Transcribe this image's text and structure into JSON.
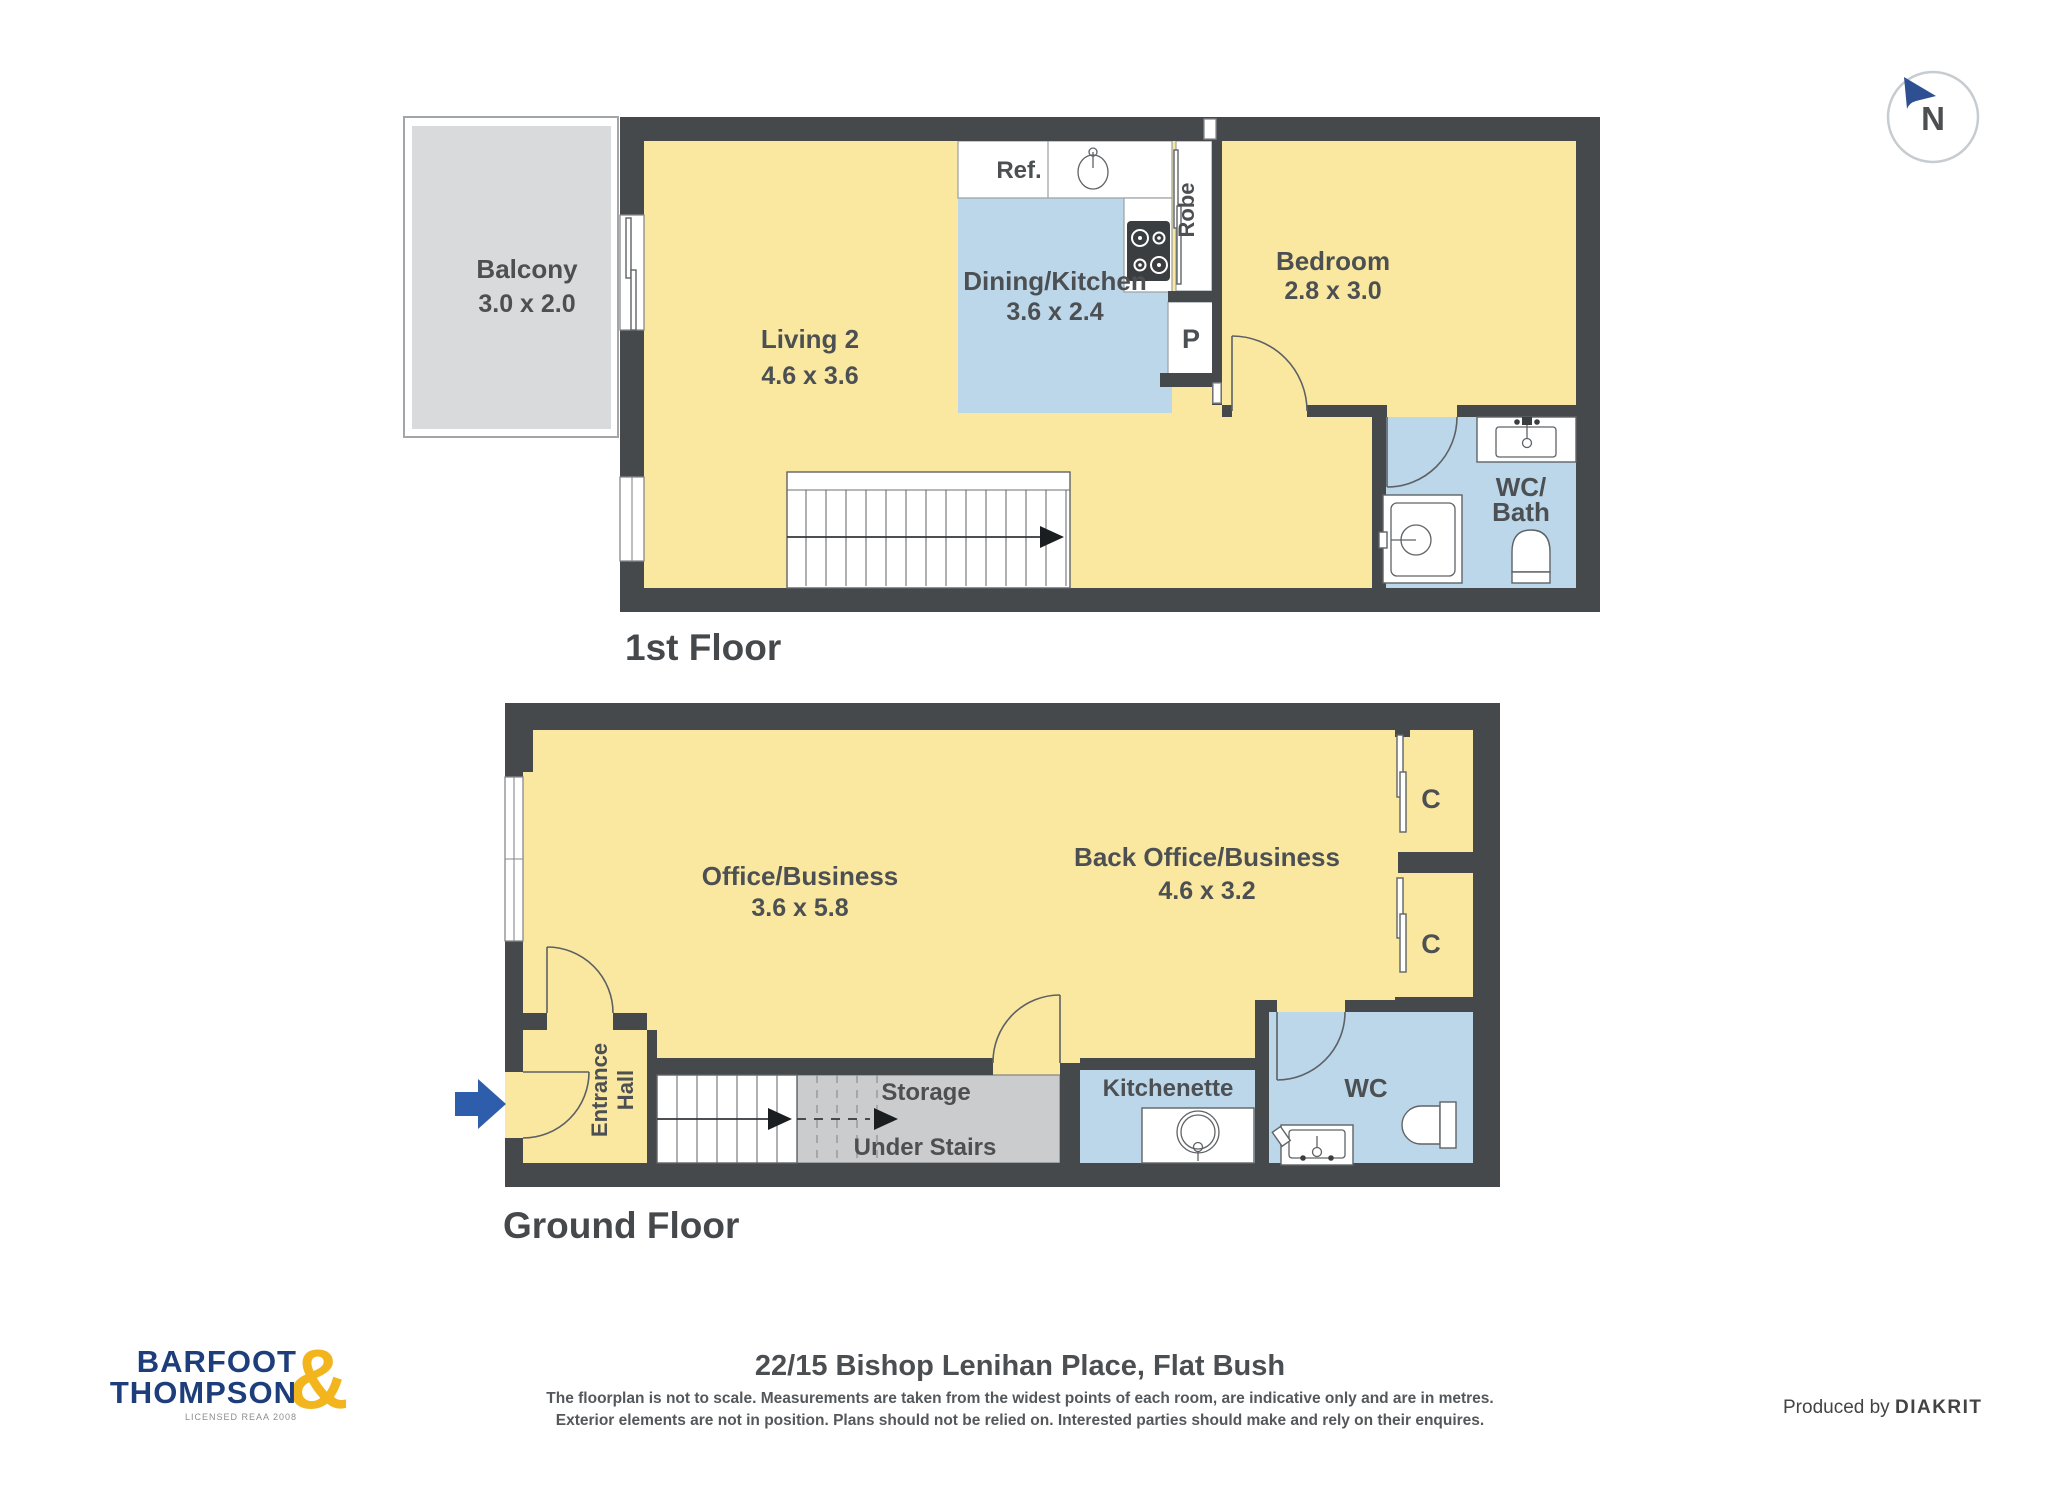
{
  "colors": {
    "wall": "#45494C",
    "floor": "#FAE8A1",
    "wet_area": "#BCD7E9",
    "balcony": "#D9DADB",
    "storage": "#CBCCCD",
    "label": "#4C5053",
    "logo_navy": "#1E3E7B",
    "logo_gold": "#F2B51D",
    "compass_navy": "#2E4F92",
    "entrance_arrow_blue": "#2E5DAB"
  },
  "compass": {
    "north_label": "N"
  },
  "first_floor": {
    "label": "1st Floor",
    "balcony_name": "Balcony",
    "balcony_dims": "3.0 x 2.0",
    "living_name": "Living 2",
    "living_dims": "4.6 x 3.6",
    "dining_name": "Dining/Kitchen",
    "dining_dims": "3.6 x 2.4",
    "bedroom_name": "Bedroom",
    "bedroom_dims": "2.8 x 3.0",
    "wc_line1": "WC/",
    "wc_line2": "Bath",
    "fridge_label": "Ref.",
    "robe_label": "Robe",
    "pantry_label": "P"
  },
  "ground_floor": {
    "label": "Ground Floor",
    "office_name": "Office/Business",
    "office_dims": "3.6 x 5.8",
    "back_office_name": "Back Office/Business",
    "back_office_dims": "4.6 x 3.2",
    "entrance_line1": "Entrance",
    "entrance_line2": "Hall",
    "storage_line1": "Storage",
    "storage_line2": "Under Stairs",
    "kitchenette_label": "Kitchenette",
    "wc_label": "WC",
    "closet1_label": "C",
    "closet2_label": "C"
  },
  "footer": {
    "address": "22/15 Bishop Lenihan Place, Flat Bush",
    "disclaimer_line1": "The floorplan is not to scale. Measurements are taken from the widest points of each room, are indicative only and are in metres.",
    "disclaimer_line2": "Exterior elements are not in position. Plans should not be relied on. Interested parties should make and rely on their enquires.",
    "produced_prefix": "Produced by",
    "produced_brand": "DIAKRIT"
  },
  "logo": {
    "line1": "BARFOOT",
    "line2": "THOMPSON",
    "ampersand": "&",
    "licensed": "LICENSED REAA 2008"
  }
}
